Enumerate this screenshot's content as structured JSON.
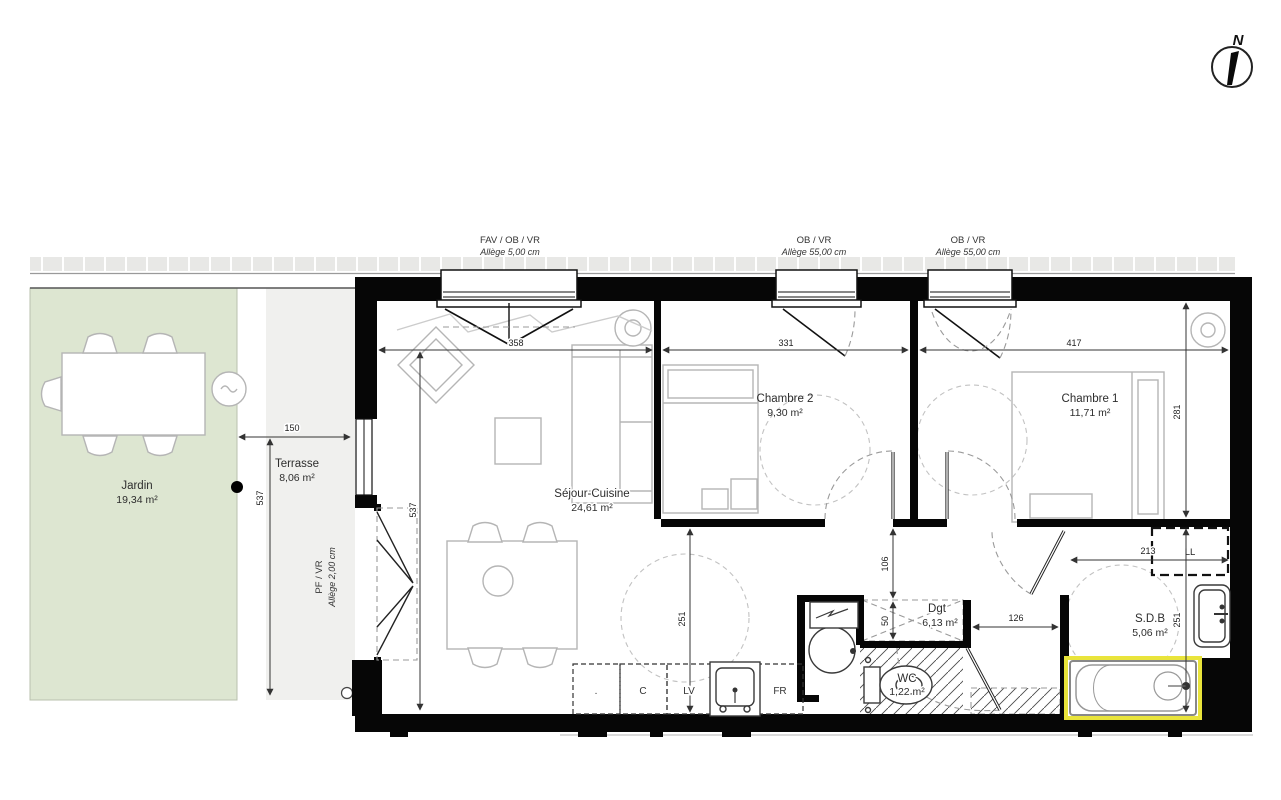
{
  "compass": {
    "north_label": "N"
  },
  "openings": {
    "window_sejour": {
      "type": "FAV / OB / VR",
      "allege": "Allège  5,00 cm"
    },
    "window_ch2": {
      "type": "OB / VR",
      "allege": "Allège  55,00 cm"
    },
    "window_ch1": {
      "type": "OB / VR",
      "allege": "Allège  55,00 cm"
    },
    "door_terrasse": {
      "type": "PF / VR",
      "allege": "Allège  2,00 cm"
    }
  },
  "rooms": {
    "jardin": {
      "name": "Jardin",
      "area": "19,34 m²"
    },
    "terrasse": {
      "name": "Terrasse",
      "area": "8,06 m²"
    },
    "sejour_cuisine": {
      "name": "Séjour-Cuisine",
      "area": "24,61 m²"
    },
    "chambre2": {
      "name": "Chambre 2",
      "area": "9,30 m²"
    },
    "chambre1": {
      "name": "Chambre 1",
      "area": "11,71 m²"
    },
    "degagement": {
      "name": "Dgt",
      "area": "6,13 m²"
    },
    "wc": {
      "name": "WC",
      "area": "1,22 m²"
    },
    "salle_de_bain": {
      "name": "S.D.B",
      "area": "5,06 m²"
    }
  },
  "dimensions": {
    "sejour_window_width": "358",
    "chambre2_width": "331",
    "chambre1_width": "417",
    "terrasse_width": "150",
    "terrasse_depth": "537",
    "sejour_depth": "537",
    "chambre1_depth": "281",
    "sejour_lower_depth": "251",
    "hall_upper": "106",
    "hall_lower": "50",
    "entry_width": "126",
    "sdb_width": "213",
    "sdb_depth": "251"
  },
  "kitchen": {
    "slot_empty": ".",
    "cupboard": "C",
    "dishwasher": "LV",
    "fridge": "FR"
  },
  "laundry": {
    "washer": "LL"
  },
  "colors": {
    "garden_fill": "#dde6d1",
    "terrace_fill": "#f0f0ee",
    "wall_fill": "#060606",
    "highlight_yellow": "#e9e43b",
    "furniture_stroke": "#b5b5b5"
  }
}
